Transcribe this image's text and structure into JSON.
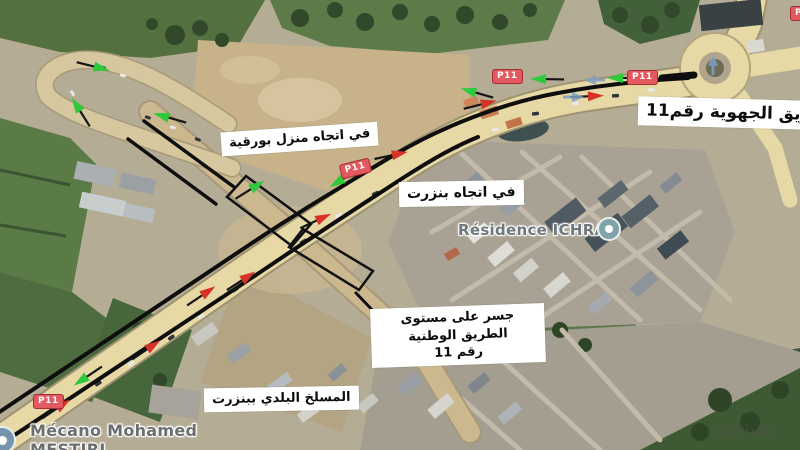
{
  "map": {
    "annotations": {
      "regional_road": "الطريق الجهوية رقم11",
      "towards_menzel_bourguiba": "في اتجاه منزل بورقية",
      "towards_bizerte": "في اتجاه بنزرت",
      "bridge_line1": "جسر على مستوى الطريق الوطنية",
      "bridge_line2": "رقم 11",
      "municipal_slaughterhouse": "المسلخ البلدي ببنزرت"
    },
    "places": {
      "residence": "Résidence ICHRAK",
      "mechanic_line1": "Mécano Mohamed",
      "mechanic_line2": "MESTIRI"
    },
    "road_badge": "P11",
    "watermark": "Active",
    "colors": {
      "arrow_green": "#2fc93c",
      "arrow_red": "#d63226",
      "arrow_blue": "#7e9fc2",
      "badge_red": "#e2595f",
      "road_yellow": "#e6d9a6",
      "route_line": "#0e0e0e"
    }
  }
}
